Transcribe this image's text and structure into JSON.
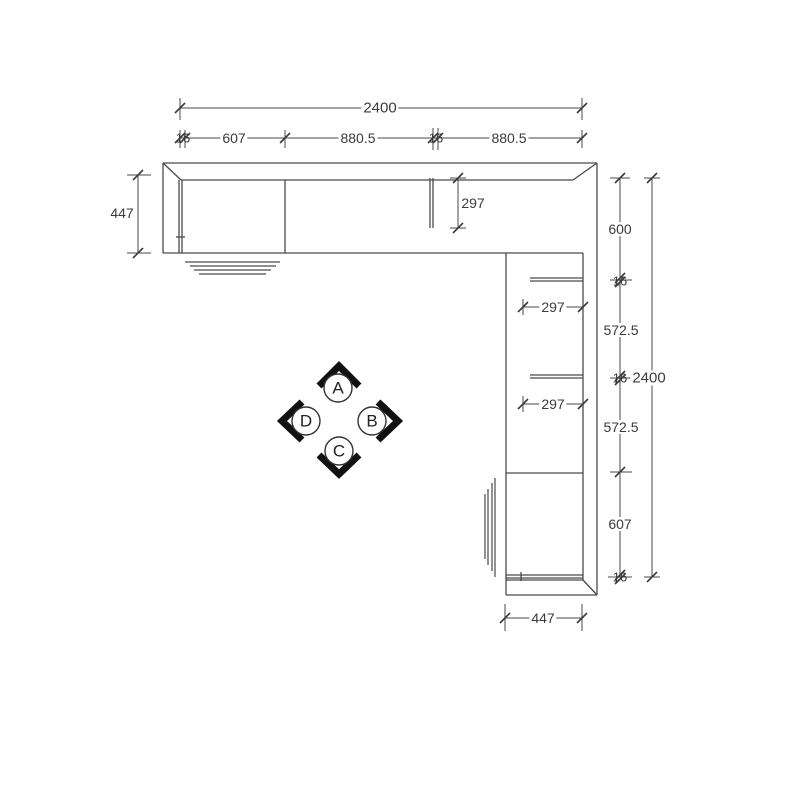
{
  "dims": {
    "top_total": "2400",
    "top_chain": [
      "16",
      "607",
      "880.5",
      "16",
      "880.5"
    ],
    "left_depth": "447",
    "top_partition_depth": "297",
    "right_chain": [
      "600",
      "16",
      "572.5",
      "16",
      "572.5",
      "607",
      "16"
    ],
    "right_total": "2400",
    "shelf_depth_1": "297",
    "shelf_depth_2": "297",
    "bottom_depth": "447"
  },
  "markers": {
    "up": "A",
    "right": "B",
    "down": "C",
    "left": "D"
  },
  "colors": {
    "line": "#4a4a4a",
    "text": "#3b3b3b",
    "arrow": "#111111"
  }
}
